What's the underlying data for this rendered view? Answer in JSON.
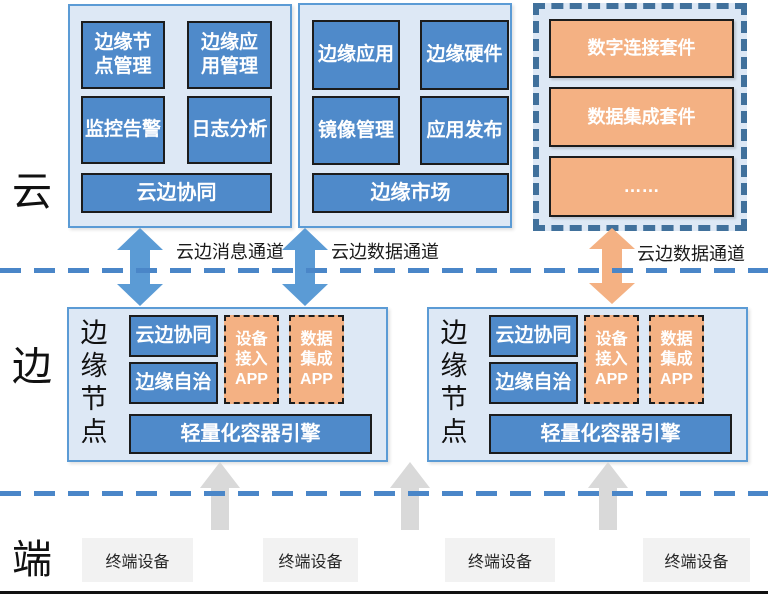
{
  "colors": {
    "module_blue": "#4F8ACA",
    "arrow_blue": "#5B9BD5",
    "panel_fill": "#DDE8F5",
    "panel_border": "#5B9BD5",
    "suite_panel_dashed_border": "#41719C",
    "suite_orange": "#F4B183",
    "dashed_divider_blue": "#4A86C8",
    "uplink_arrow_gray": "#D9D9D9",
    "device_box_fill": "#F2F2F2"
  },
  "layers": {
    "cloud_label": "云",
    "edge_label": "边",
    "device_label": "端"
  },
  "cloud": {
    "edge_management": {
      "modules": [
        "边缘节\n点管理",
        "边缘应\n用管理",
        "监控告警",
        "日志分析"
      ],
      "footer": "云边协同"
    },
    "edge_market": {
      "modules": [
        "边缘应用",
        "边缘硬件",
        "镜像管理",
        "应用发布"
      ],
      "footer": "边缘市场"
    },
    "suites": {
      "items": [
        "数字连接套件",
        "数据集成套件",
        "……"
      ]
    }
  },
  "channels": [
    {
      "label": "云边消息通道"
    },
    {
      "label": "云边数据通道"
    },
    {
      "label": "云边数据通道"
    }
  ],
  "edge_nodes": [
    {
      "title": "边\n缘\n节\n点",
      "modules": [
        "云边协同",
        "边缘自治"
      ],
      "apps": [
        "设备\n接入\nAPP",
        "数据\n集成\nAPP"
      ],
      "engine": "轻量化容器引擎"
    },
    {
      "title": "边\n缘\n节\n点",
      "modules": [
        "云边协同",
        "边缘自治"
      ],
      "apps": [
        "设备\n接入\nAPP",
        "数据\n集成\nAPP"
      ],
      "engine": "轻量化容器引擎"
    }
  ],
  "devices": [
    "终端设备",
    "终端设备",
    "终端设备",
    "终端设备"
  ]
}
